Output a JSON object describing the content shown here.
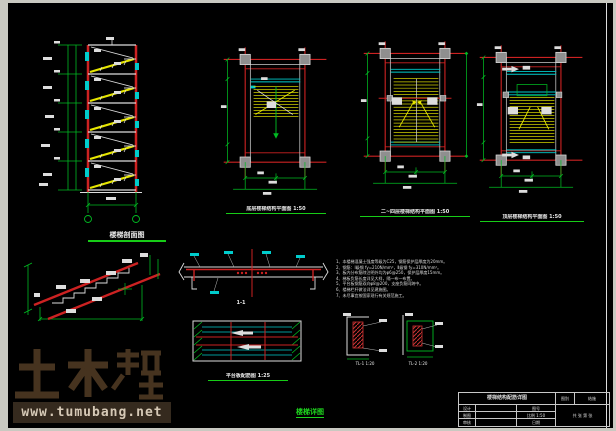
{
  "frame": {
    "outer_color": "#c9c9c1",
    "canvas_color": "#000000"
  },
  "palette": {
    "red": "#cc2222",
    "green": "#00bb22",
    "yellow": "#e0e000",
    "cyan": "#00cccc",
    "white": "#dddddd",
    "column_gray": "#8f8f8f"
  },
  "titles": {
    "section": "楼梯剖面图",
    "plan_bottom": "底层楼梯结构平面图 1:50",
    "plan_middle": "二~四层楼梯结构平面图 1:50",
    "plan_top": "顶层楼梯结构平面图 1:50",
    "beam_section_label": "1-1",
    "landing_plan": "平台板配筋图 1:25",
    "detail_left": "TL-1 1:20",
    "detail_right": "TL-2 1:20",
    "stamp": "楼梯详图"
  },
  "notes": {
    "lines": [
      "1、本楼梯混凝土强度等级为C25，钢筋保护层厚度为20mm。",
      "2、钢筋：Ⅰ级钢 fy=210N/mm²，Ⅱ级钢 fy=310N/mm²。",
      "3、板内分布筋除注明外均为φ6@250，保护层厚度15mm。",
      "4、梯板负筋长度详见大样，隔一布一布置。",
      "5、平台板钢筋双向φ8@200，支座负筋同跨中。",
      "6、楼梯栏杆做法详见建施图。",
      "7、未尽事宜按国家现行有关规范施工。"
    ]
  },
  "title_block": {
    "project": "楼梯结构配筋详图",
    "type_label": "图别",
    "type_value": "结施",
    "rows": [
      {
        "label": "设计",
        "value": "",
        "extra": "图号"
      },
      {
        "label": "制图",
        "value": "",
        "extra": "比例 1:50"
      },
      {
        "label": "审核",
        "value": "",
        "extra": "日期"
      }
    ],
    "sheet_note": "共 张 第 张"
  },
  "watermark": {
    "logo_text": "土木帮",
    "url": "www.tumubang.net"
  }
}
